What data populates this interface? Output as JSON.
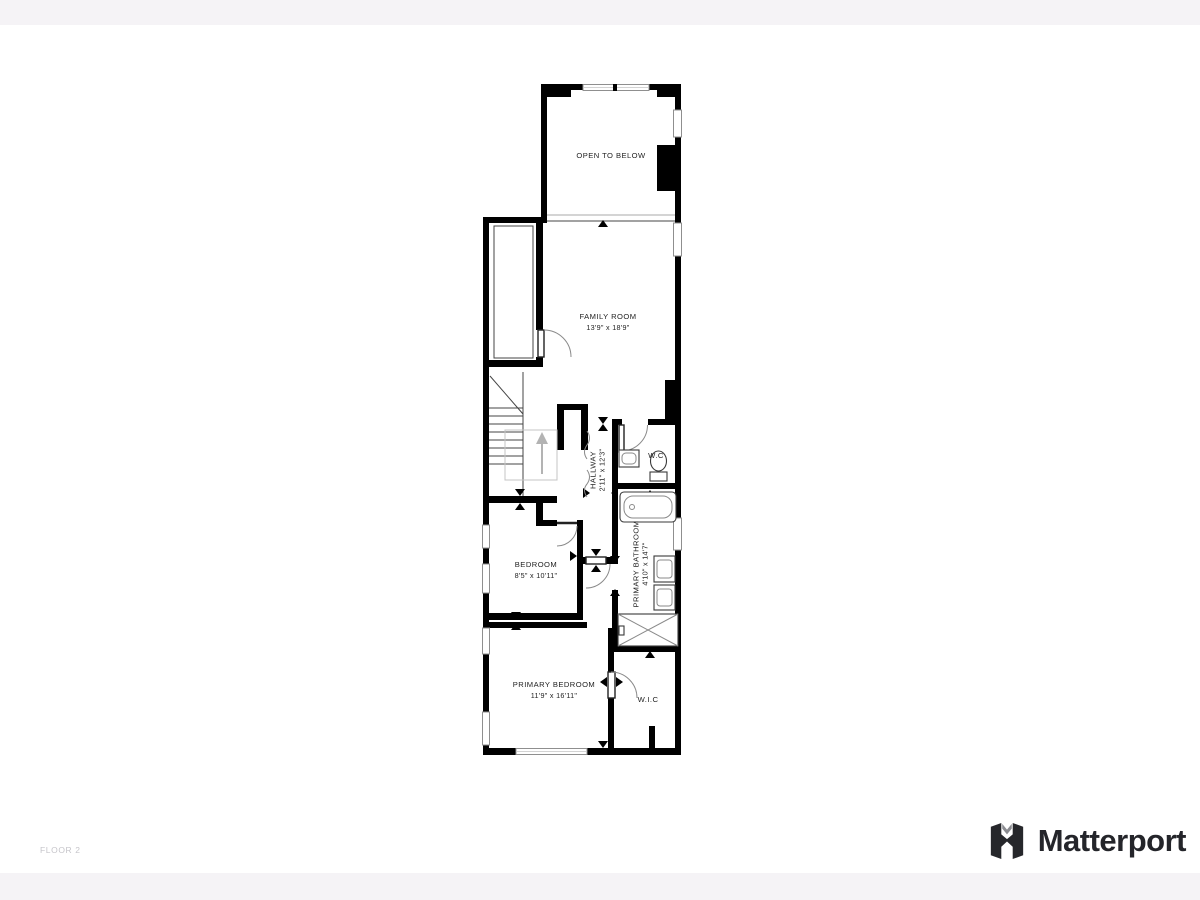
{
  "page": {
    "background": "#ffffff",
    "top_band_color": "#f5f3f6",
    "bottom_band_color": "#f5f3f6"
  },
  "footer": {
    "floor_label": "FLOOR 2",
    "brand": "Matterport",
    "brand_text_color": "#24252a",
    "floor_label_color": "#c6c5ca"
  },
  "floorplan": {
    "wall_color": "#000000",
    "window_color": "#8f8f8f",
    "stairs_arrow_color": "#b3b3b3",
    "rooms": [
      {
        "id": "open-to-below",
        "label": "OPEN TO BELOW",
        "dims": ""
      },
      {
        "id": "family-room",
        "label": "FAMILY ROOM",
        "dims": "13'9\" x 18'9\""
      },
      {
        "id": "hallway",
        "label": "HALLWAY",
        "dims": "2'11\" x 12'3\""
      },
      {
        "id": "wc",
        "label": "W.C",
        "dims": ""
      },
      {
        "id": "primary-bathroom",
        "label": "PRIMARY BATHROOM",
        "dims": "4'10\" x 14'7\""
      },
      {
        "id": "bedroom",
        "label": "BEDROOM",
        "dims": "8'5\" x 10'11\""
      },
      {
        "id": "primary-bedroom",
        "label": "PRIMARY BEDROOM",
        "dims": "11'9\" x 16'11\""
      },
      {
        "id": "wic",
        "label": "W.I.C",
        "dims": ""
      }
    ]
  }
}
